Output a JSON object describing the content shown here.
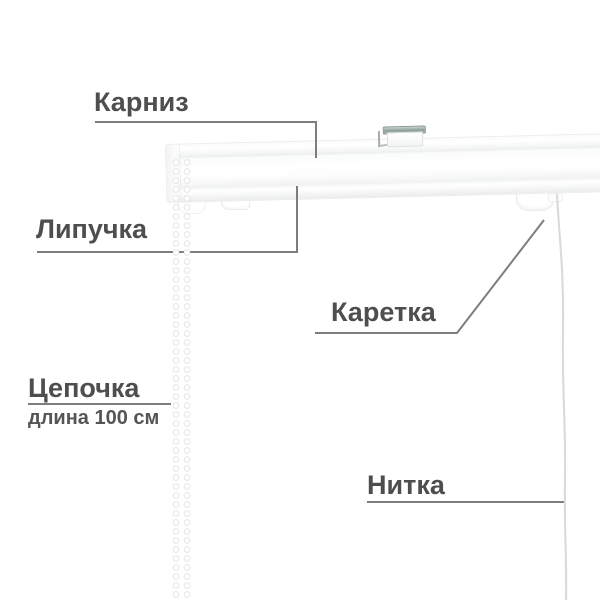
{
  "annotations": {
    "cornice": {
      "label": "Карниз"
    },
    "velcro": {
      "label": "Липучка"
    },
    "carriage": {
      "label": "Каретка"
    },
    "chain": {
      "label": "Цепочка",
      "note": "длина 100 см"
    },
    "thread": {
      "label": "Нитка"
    }
  },
  "colors": {
    "background": "#ffffff",
    "label_text": "#4e4e4e",
    "pointer_line": "#7d7d7d",
    "rail_body": "#ffffff",
    "bracket_metal": "#8d9e98",
    "thread_line": "#d9d9d9",
    "chain_bead_rim": "#dfdfdf"
  }
}
